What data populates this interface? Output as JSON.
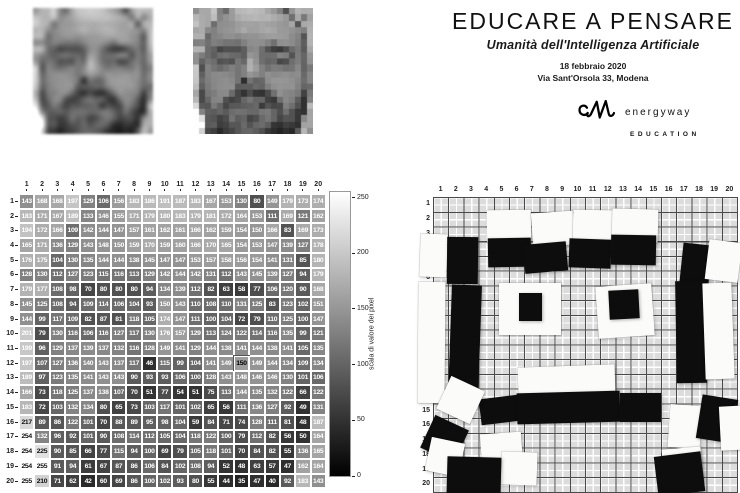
{
  "header": {
    "title": "EDUCARE A PENSARE",
    "subtitle": "Umanità dell'Intelligenza Artificiale",
    "date": "18 febbraio 2020",
    "address": "Via Sant'Orsola 33, Modena",
    "logo": {
      "brand": "energyway",
      "sub": "EDUCATION"
    }
  },
  "chart_data": [
    {
      "type": "heatmap",
      "title": "",
      "colormap": "gray",
      "vmin": 0,
      "vmax": 255,
      "x_labels": [
        "1",
        "2",
        "3",
        "4",
        "5",
        "6",
        "7",
        "8",
        "9",
        "10",
        "11",
        "12",
        "13",
        "14",
        "15",
        "16",
        "17",
        "18",
        "19",
        "20"
      ],
      "y_labels": [
        "1",
        "2",
        "3",
        "4",
        "5",
        "6",
        "7",
        "8",
        "9",
        "10",
        "11",
        "12",
        "13",
        "14",
        "15",
        "16",
        "17",
        "18",
        "19",
        "20"
      ],
      "values": [
        [
          143,
          168,
          168,
          197,
          129,
          106,
          156,
          183,
          186,
          191,
          187,
          183,
          167,
          153,
          130,
          80,
          149,
          179,
          173,
          174
        ],
        [
          183,
          171,
          167,
          189,
          133,
          146,
          155,
          171,
          179,
          180,
          183,
          179,
          181,
          172,
          164,
          153,
          111,
          169,
          121,
          162
        ],
        [
          194,
          172,
          166,
          109,
          142,
          144,
          147,
          157,
          161,
          162,
          161,
          166,
          162,
          159,
          154,
          150,
          166,
          83,
          169,
          173
        ],
        [
          165,
          171,
          136,
          129,
          143,
          148,
          150,
          159,
          170,
          159,
          160,
          166,
          170,
          165,
          154,
          153,
          147,
          139,
          127,
          178
        ],
        [
          176,
          175,
          104,
          130,
          135,
          144,
          144,
          138,
          145,
          147,
          147,
          153,
          157,
          158,
          156,
          154,
          141,
          131,
          85,
          180
        ],
        [
          128,
          130,
          112,
          127,
          123,
          115,
          116,
          113,
          129,
          142,
          144,
          142,
          131,
          112,
          143,
          145,
          139,
          127,
          94,
          179
        ],
        [
          179,
          177,
          108,
          98,
          70,
          80,
          80,
          80,
          94,
          134,
          139,
          112,
          82,
          63,
          58,
          77,
          106,
          120,
          90,
          168
        ],
        [
          145,
          125,
          108,
          94,
          109,
          114,
          106,
          104,
          93,
          150,
          143,
          110,
          108,
          110,
          131,
          125,
          83,
          123,
          102,
          151
        ],
        [
          144,
          99,
          117,
          109,
          82,
          87,
          81,
          118,
          105,
          174,
          147,
          111,
          100,
          104,
          72,
          79,
          110,
          125,
          100,
          147
        ],
        [
          201,
          79,
          130,
          116,
          106,
          116,
          127,
          117,
          130,
          176,
          157,
          129,
          113,
          124,
          122,
          114,
          116,
          135,
          99,
          121
        ],
        [
          199,
          96,
          129,
          137,
          139,
          137,
          132,
          116,
          128,
          149,
          141,
          129,
          144,
          138,
          141,
          144,
          138,
          141,
          105,
          135
        ],
        [
          197,
          107,
          127,
          136,
          140,
          143,
          137,
          117,
          46,
          115,
          99,
          104,
          141,
          149,
          150,
          149,
          144,
          134,
          109,
          134
        ],
        [
          189,
          97,
          123,
          135,
          141,
          143,
          143,
          90,
          93,
          93,
          106,
          100,
          128,
          143,
          148,
          146,
          146,
          130,
          101,
          106
        ],
        [
          166,
          73,
          118,
          125,
          137,
          138,
          107,
          70,
          51,
          77,
          54,
          51,
          75,
          113,
          144,
          135,
          132,
          122,
          66,
          122
        ],
        [
          183,
          72,
          103,
          132,
          134,
          80,
          65,
          73,
          103,
          117,
          101,
          102,
          65,
          56,
          111,
          136,
          127,
          92,
          49,
          131
        ],
        [
          217,
          89,
          86,
          122,
          101,
          70,
          88,
          89,
          95,
          98,
          104,
          59,
          84,
          71,
          74,
          128,
          111,
          81,
          48,
          187
        ],
        [
          254,
          132,
          96,
          92,
          101,
          90,
          108,
          114,
          112,
          105,
          104,
          118,
          122,
          100,
          79,
          112,
          82,
          56,
          50,
          164
        ],
        [
          254,
          225,
          90,
          85,
          66,
          77,
          115,
          94,
          100,
          69,
          79,
          105,
          118,
          101,
          70,
          84,
          82,
          55,
          136,
          165
        ],
        [
          254,
          255,
          91,
          94,
          61,
          67,
          87,
          86,
          106,
          84,
          102,
          108,
          94,
          52,
          48,
          63,
          57,
          47,
          162,
          164
        ],
        [
          255,
          210,
          71,
          62,
          42,
          60,
          69,
          86,
          100,
          102,
          93,
          80,
          55,
          44,
          35,
          47,
          40,
          92,
          183,
          143
        ]
      ],
      "highlight_cell": {
        "row": 12,
        "col": 15
      },
      "colorbar_label": "scala di valore dei pixel",
      "colorbar_ticks": [
        0,
        50,
        100,
        150,
        200,
        250
      ]
    },
    {
      "type": "tile-mosaic",
      "x_labels": [
        "1",
        "2",
        "3",
        "4",
        "5",
        "6",
        "7",
        "8",
        "9",
        "10",
        "11",
        "12",
        "13",
        "14",
        "15",
        "16",
        "17",
        "18",
        "19",
        "20"
      ],
      "y_labels": [
        "1",
        "2",
        "3",
        "4",
        "5",
        "6",
        "7",
        "8",
        "9",
        "10",
        "11",
        "12",
        "13",
        "14",
        "15",
        "16",
        "17",
        "18",
        "19",
        "20"
      ],
      "tile_colors": {
        "w": "#fbfbf9",
        "k": "#0d0d0d"
      },
      "tiles": [
        [
          3.55,
          0.85,
          2.9,
          2.15,
          "w",
          -0.5
        ],
        [
          6.5,
          1.05,
          2.75,
          2.3,
          "w",
          -4
        ],
        [
          9.2,
          0.9,
          2.65,
          2.3,
          "w",
          1
        ],
        [
          11.8,
          0.8,
          3.0,
          2.25,
          "w",
          1.5
        ],
        [
          -0.85,
          2.5,
          1.75,
          2.9,
          "w",
          2
        ],
        [
          0.9,
          2.7,
          2.05,
          3.2,
          "k",
          0.5
        ],
        [
          3.6,
          2.75,
          2.85,
          1.95,
          "k",
          -1
        ],
        [
          6.0,
          3.1,
          2.85,
          1.95,
          "k",
          -5
        ],
        [
          8.95,
          2.85,
          2.75,
          1.95,
          "k",
          2
        ],
        [
          11.7,
          2.6,
          2.95,
          2.0,
          "k",
          1
        ],
        [
          16.3,
          3.2,
          1.9,
          3.25,
          "k",
          6
        ],
        [
          18.0,
          3.0,
          2.2,
          2.7,
          "w",
          7
        ],
        [
          -1.0,
          5.75,
          1.8,
          8.2,
          "w",
          0.5
        ],
        [
          1.1,
          5.95,
          2.0,
          7.6,
          "k",
          2
        ],
        [
          16.0,
          5.7,
          2.0,
          6.9,
          "k",
          -1
        ],
        [
          17.85,
          5.8,
          1.9,
          6.5,
          "w",
          -2
        ],
        [
          4.35,
          5.8,
          4.05,
          3.55,
          "w",
          0
        ],
        [
          5.65,
          6.5,
          1.5,
          1.9,
          "k",
          0
        ],
        [
          10.8,
          5.95,
          3.7,
          3.5,
          "w",
          -4
        ],
        [
          11.6,
          6.3,
          1.95,
          1.95,
          "k",
          -3
        ],
        [
          5.6,
          11.45,
          6.35,
          1.95,
          "w",
          -2
        ],
        [
          3.1,
          13.55,
          2.6,
          1.75,
          "k",
          -7
        ],
        [
          5.55,
          13.2,
          6.8,
          2.1,
          "k",
          -1.5
        ],
        [
          12.3,
          13.3,
          2.7,
          1.95,
          "k",
          0
        ],
        [
          0.6,
          12.55,
          2.45,
          2.45,
          "w",
          25
        ],
        [
          -0.45,
          15.2,
          2.45,
          2.45,
          "k",
          25
        ],
        [
          -0.3,
          16.5,
          2.25,
          2.3,
          "w",
          12
        ],
        [
          3.15,
          16.0,
          2.7,
          2.2,
          "w",
          -4
        ],
        [
          4.45,
          17.3,
          2.4,
          2.25,
          "w",
          2
        ],
        [
          0.95,
          17.6,
          3.55,
          2.6,
          "k",
          1.5
        ],
        [
          15.5,
          14.1,
          2.1,
          2.9,
          "w",
          4
        ],
        [
          17.5,
          13.55,
          2.4,
          3.0,
          "k",
          9
        ],
        [
          18.85,
          14.15,
          1.9,
          2.95,
          "w",
          -3
        ],
        [
          15.1,
          17.0,
          2.55,
          2.35,
          "w",
          -5
        ],
        [
          14.7,
          17.45,
          3.1,
          2.7,
          "k",
          -7
        ]
      ]
    }
  ]
}
